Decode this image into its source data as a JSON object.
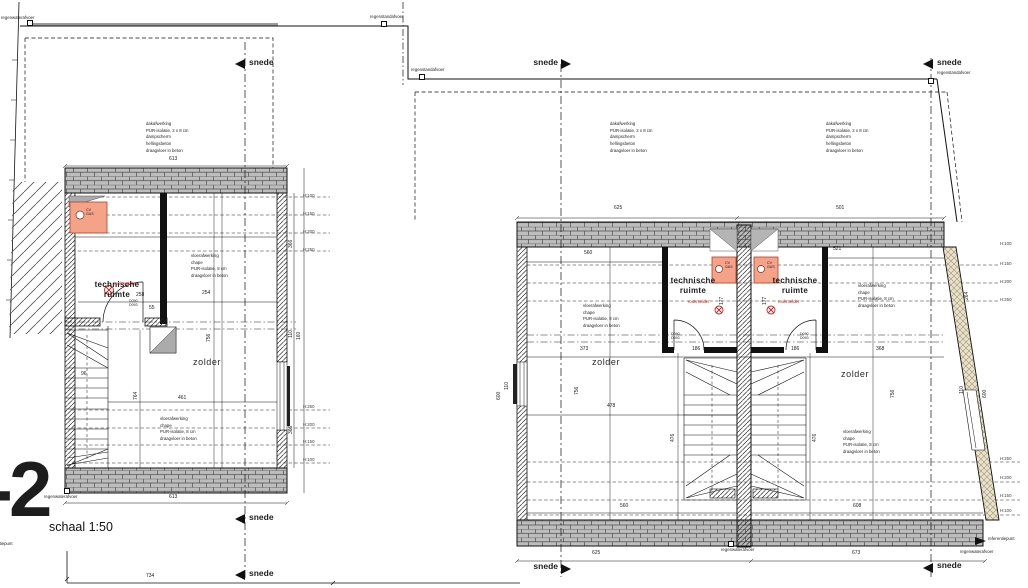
{
  "title": {
    "level": "-2",
    "scale": "schaal 1:50"
  },
  "labels": {
    "snede": "snede",
    "regenwaterafvoer": "regenwaterafvoer",
    "regenstandafvoer": "regenstandafvoer",
    "referentiepunt": "referentiepunt",
    "technische_ruimte": "technische\nruimte",
    "zolder": "zolder",
    "rookmelder": "rookmelder",
    "cv_gas": "CV\nGAS",
    "door_codes": "D090\nD093"
  },
  "notes": {
    "roof": "dakafwerking\nPUR-isolatie, 2 x 8 cm\ndampscherm\nhellingsbeton\ndraagvloer in beton",
    "floor": "vloerafwerking\nchape\nPUR-isolatie, 8 cm\ndraagvloer in beton"
  },
  "heights": {
    "h100": "H:100",
    "h150": "H:150",
    "h200": "H:200",
    "h250": "H:250"
  },
  "dims": {
    "left": {
      "width_top": "613",
      "width_bottom": "613",
      "site_width": "734",
      "wall_upper": "366",
      "wall_lower": "366",
      "win_a": "110",
      "win_b": "160",
      "tech_w": "258",
      "tech_d": "254",
      "door": "55",
      "stair": "96",
      "zolder_w": "461",
      "depth": "756",
      "stair_run": "764"
    },
    "right": {
      "top_l": "625",
      "top_r": "501",
      "inner_top_l": "560",
      "inner_top_r": "521",
      "inner_bot_l": "560",
      "inner_bot_r": "608",
      "bot_l": "625",
      "bot_r": "673",
      "zl_a": "373",
      "zl_b": "478",
      "zr": "368",
      "tech_l": "186",
      "tech_r": "186",
      "tech_il": "177",
      "tech_ir": "177",
      "stair_l": "476",
      "stair_r": "476",
      "depth_l": "756",
      "depth_r": "756",
      "win_l": "110",
      "edge_l": "600",
      "win_r": "110",
      "edge_r": "600",
      "slant": "264"
    }
  }
}
